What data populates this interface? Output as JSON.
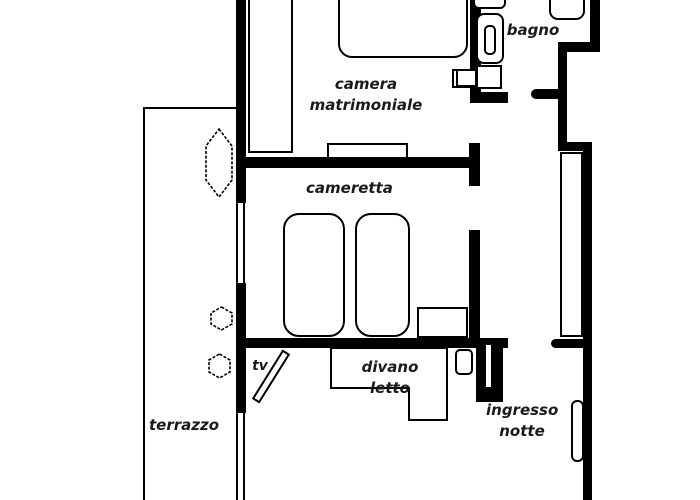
{
  "title": "apartment floor plan",
  "colors": {
    "wall": "#000000",
    "background": "#ffffff",
    "outline": "#000000",
    "text": "#1a1a1a"
  },
  "labels": {
    "bagno": "bagno",
    "camera_matrimoniale": "camera matrimoniale",
    "cameretta": "cameretta",
    "divano_letto": "divano letto",
    "tv": "tv",
    "terrazzo": "terrazzo",
    "ingresso_notte": "ingresso notte"
  }
}
